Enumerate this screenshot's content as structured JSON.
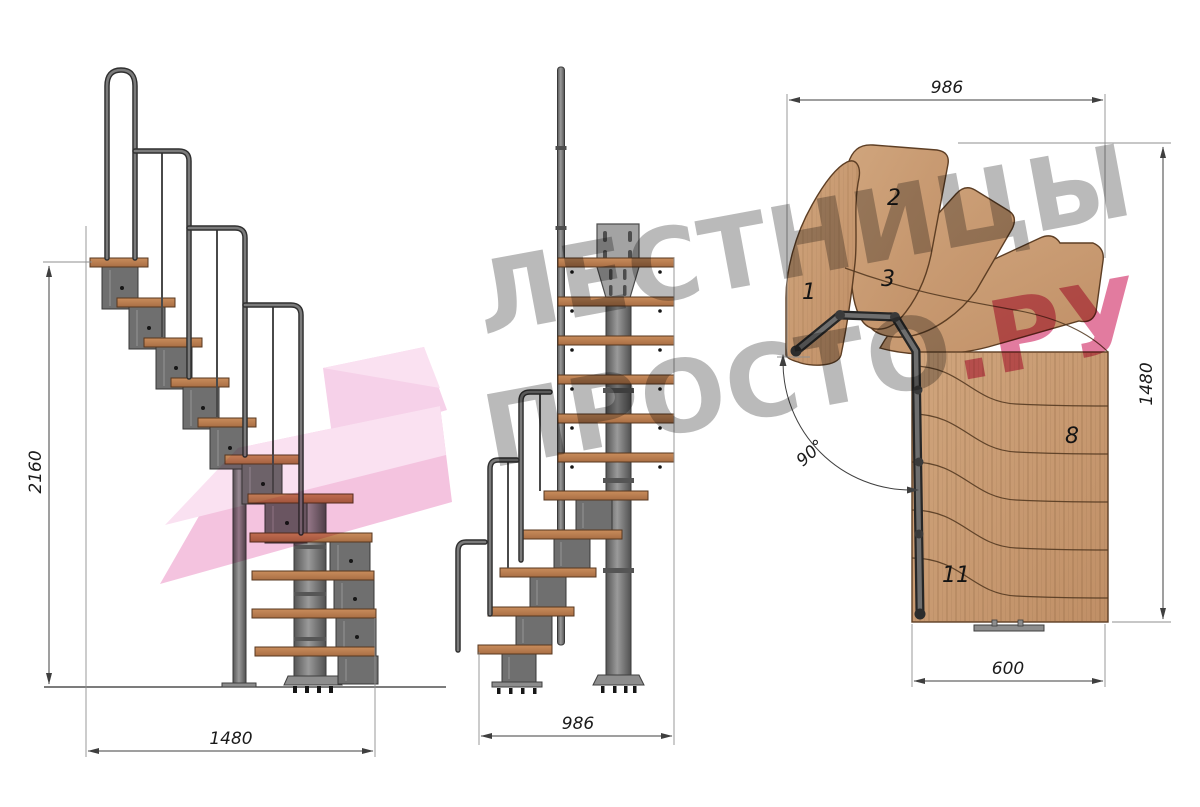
{
  "watermark": {
    "line1": "ЛЕСТНИЦЫ",
    "line2": "ПРОСТО",
    "accent": ".РУ"
  },
  "side_view": {
    "dim_height": "2160",
    "dim_width": "1480"
  },
  "front_view": {
    "dim_width": "986"
  },
  "plan_view": {
    "dim_top": "986",
    "dim_right": "1480",
    "dim_bottom": "600",
    "dim_angle": "90°",
    "steps": {
      "s1": "1",
      "s2": "2",
      "s3": "3",
      "s8": "8",
      "s11": "11"
    }
  },
  "colors": {
    "wood": "#c89a72",
    "wood_dark": "#a96e44",
    "metal": "#6f6f6f",
    "metal_dark": "#3a3a3a",
    "dimension": "#3f3f3f",
    "watermark_gray": "#767676",
    "watermark_pink": "#d02a64",
    "logo_pink": "#f2b9da"
  }
}
